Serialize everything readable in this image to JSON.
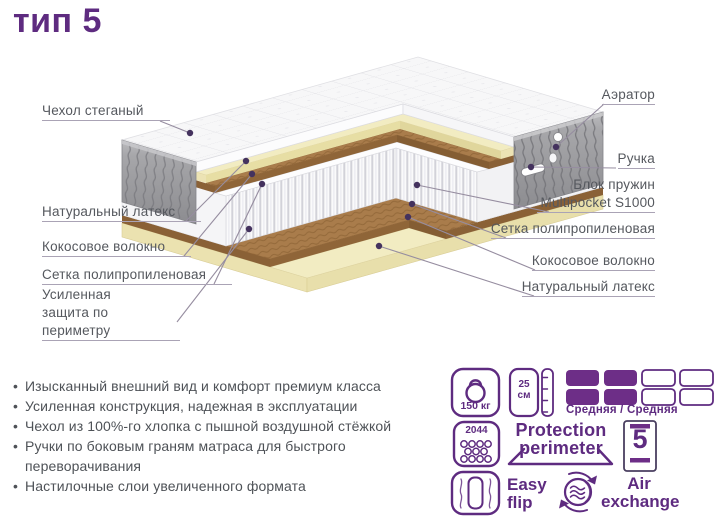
{
  "title": "тип 5",
  "colors": {
    "accent": "#5e2b80",
    "accent_fill": "#6d2e87",
    "label_text": "#55585e",
    "latex": "#f2ecc2",
    "coconut": "#a97c4b",
    "border_gray": "#9a9a9c"
  },
  "layers": {
    "left": [
      "Чехол стеганый",
      "Натуральный латекс",
      "Кокосовое волокно",
      "Сетка полипропиленовая",
      "Усиленная защита по периметру"
    ],
    "right": [
      "Аэратор",
      "Ручка",
      "Блок пружин Multipocket S1000",
      "Сетка полипропиленовая",
      "Кокосовое волокно",
      "Натуральный латекс"
    ]
  },
  "features": [
    "Изысканный внешний вид и комфорт премиум класса",
    "Усиленная конструкция, надежная в эксплуатации",
    "Чехол из 100%-го хлопка с пышной воздушной стёжкой",
    "Ручки по боковым граням матраса для быстрого переворачивания",
    "Настилочные слои увеличенного формата"
  ],
  "badges": {
    "max_weight": "150 кг",
    "height_value": "25",
    "height_unit": "см",
    "firmness": "Средняя / Средняя",
    "springs_count": "2044",
    "protection_word1": "Protection",
    "protection_word2": "perimeter",
    "warranty_years": "5",
    "easy_flip_word1": "Easy",
    "easy_flip_word2": "flip",
    "air_word1": "Air",
    "air_word2": "exchange"
  }
}
